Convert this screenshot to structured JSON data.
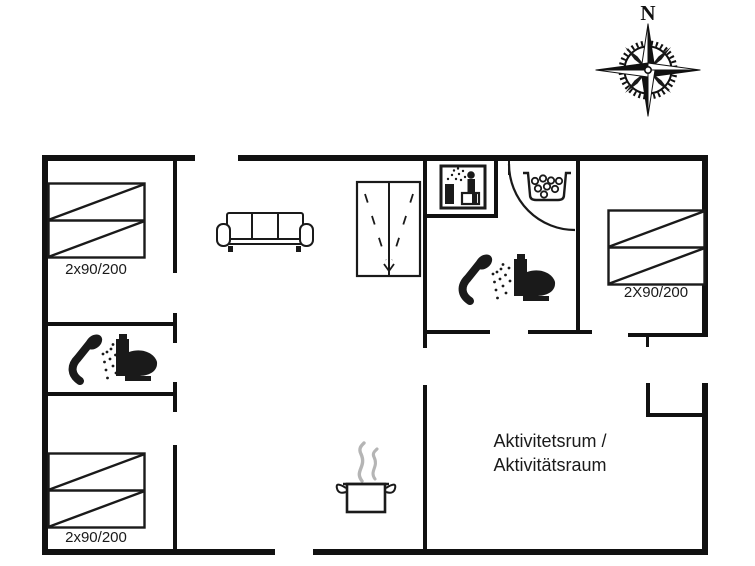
{
  "floorplan": {
    "compass": {
      "label": "N"
    },
    "bedrooms": {
      "top_left_bed_label": "2x90/200",
      "bottom_left_bed_label": "2x90/200",
      "right_bed_label": "2X90/200"
    },
    "activity_room": {
      "label_line1": "Aktivitetsrum /",
      "label_line2": "Aktivitätsraum"
    },
    "icons": [
      "compass-rose-icon",
      "sofa-icon",
      "wardrobe-icon",
      "sauna-icon",
      "whirlpool-icon",
      "shower-icon",
      "toilet-icon",
      "cooking-pot-icon",
      "steam-icon",
      "bed-icon",
      "door-swing-arc"
    ],
    "colors": {
      "wall": "#111111",
      "line": "#1a1a1a",
      "steam": "#b5b5b5",
      "bg": "#ffffff"
    }
  }
}
